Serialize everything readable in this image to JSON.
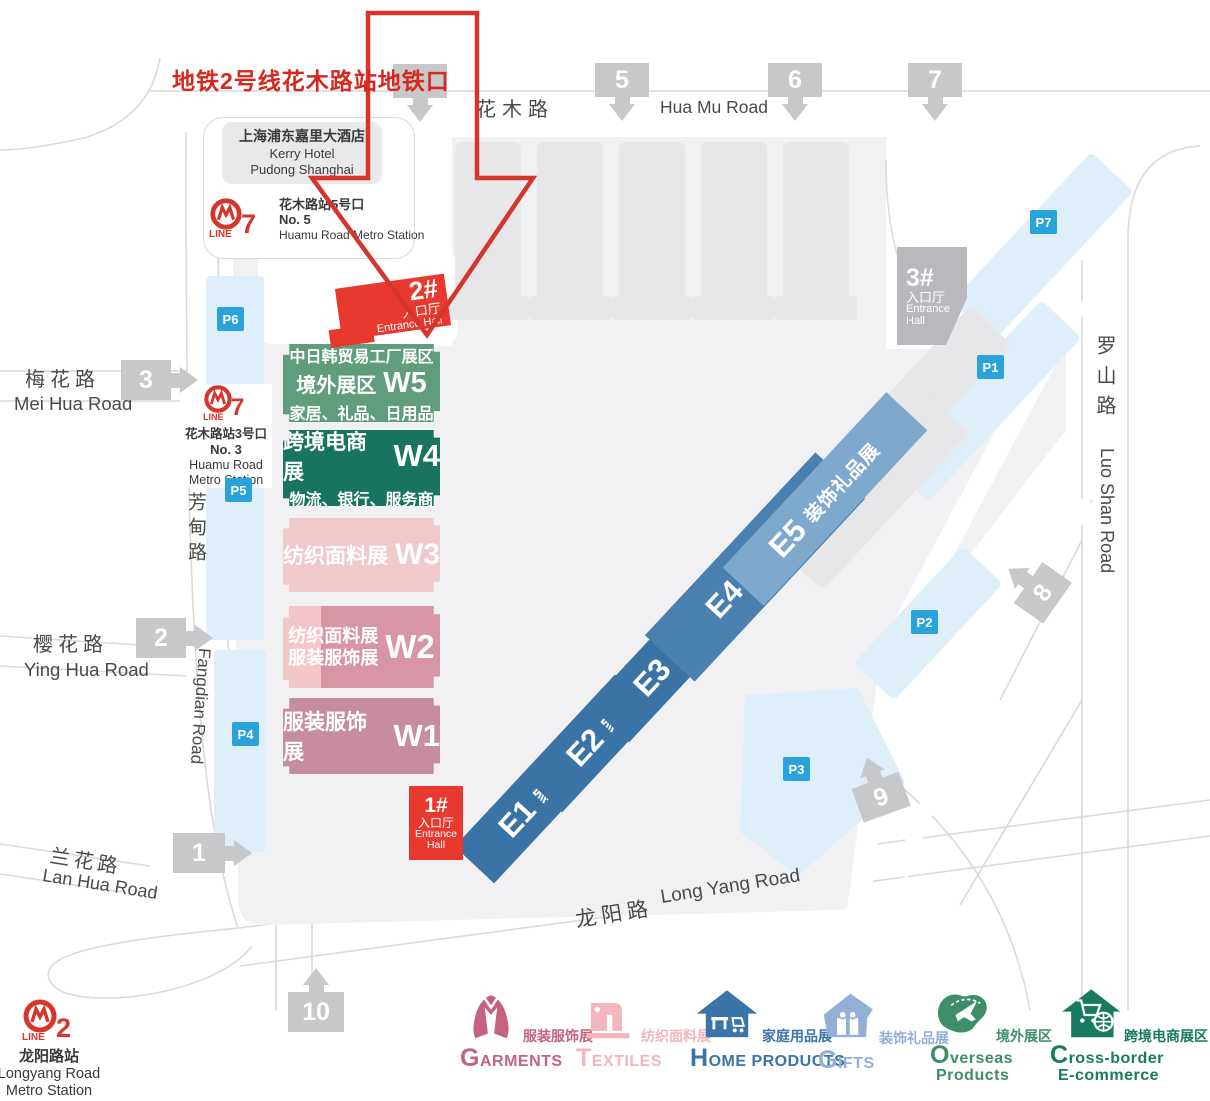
{
  "callout_title": "地铁2号线花木路站地铁口",
  "hotel": {
    "zh": "上海浦东嘉里大酒店",
    "en1": "Kerry Hotel",
    "en2": "Pudong Shanghai"
  },
  "metro": {
    "line_word": "LINE",
    "line7_no5": {
      "num": "7",
      "exit_zh": "花木路站5号口",
      "exit_en": "No. 5",
      "st_en": "Huamu Road Metro Station"
    },
    "line7_no3": {
      "num": "7",
      "exit_zh": "花木路站3号口",
      "exit_en": "No. 3",
      "st_en1": "Huamu Road",
      "st_en2": "Metro Station"
    },
    "line2": {
      "num": "2",
      "st_zh": "龙阳路站",
      "st_en1": "Longyang Road",
      "st_en2": "Metro Station"
    }
  },
  "roads": {
    "huamu_zh": "花木路",
    "huamu_en": "Hua Mu Road",
    "meihua_zh": "梅花路",
    "meihua_en": "Mei Hua Road",
    "yinghua_zh": "樱花路",
    "yinghua_en": "Ying Hua Road",
    "lanhua_zh": "兰花路",
    "lanhua_en": "Lan Hua Road",
    "fangdian_zh": "芳甸路",
    "fangdian_en": "Fangdian Road",
    "longyang_zh": "龙阳路",
    "longyang_en": "Long Yang Road",
    "luoshan_zh": "罗山路",
    "luoshan_en": "Luo Shan Road"
  },
  "gates": {
    "g1": "1",
    "g2": "2",
    "g3": "3",
    "g5": "5",
    "g6": "6",
    "g7": "7",
    "g8": "8",
    "g9": "9",
    "g10": "10"
  },
  "parking": {
    "p1": "P1",
    "p2": "P2",
    "p3": "P3",
    "p4": "P4",
    "p5": "P5",
    "p6": "P6",
    "p7": "P7"
  },
  "entrances": {
    "e1": {
      "num": "1#",
      "zh": "入口厅",
      "en1": "Entrance",
      "en2": "Hall"
    },
    "e2": {
      "num": "2#",
      "zh": "入口厅",
      "en": "Entrance Hall"
    },
    "e3": {
      "num": "3#",
      "zh": "入口厅",
      "en1": "Entrance",
      "en2": "Hall"
    }
  },
  "halls": {
    "w5": {
      "l1": "中日韩贸易工厂展区",
      "l2": "境外展区",
      "id": "W5",
      "l3": "家居、礼品、日用品"
    },
    "w4": {
      "l1": "跨境电商展",
      "id": "W4",
      "l2": "物流、银行、服务商"
    },
    "w3": {
      "l1": "纺织面料展",
      "id": "W3"
    },
    "w2": {
      "l1": "纺织面料展",
      "l2": "服装服饰展",
      "id": "W2"
    },
    "w1": {
      "l1": "服装服饰展",
      "id": "W1"
    },
    "e1": {
      "id": "E1",
      "label": "家庭用品展"
    },
    "e2": {
      "id": "E2",
      "label": "家庭用品展"
    },
    "e3": {
      "id": "E3",
      "label": "家庭用品展"
    },
    "e4": {
      "id": "E4",
      "l1": "装饰礼品展",
      "l2": "家庭用品展"
    },
    "e5": {
      "id": "E5",
      "label": "装饰礼品展"
    }
  },
  "legend": [
    {
      "first": "G",
      "rest": "ARMENTS",
      "zh": "服装服饰展"
    },
    {
      "first": "T",
      "rest": "EXTILES",
      "zh": "纺织面料展"
    },
    {
      "first": "H",
      "rest": "OME PRODUCTS",
      "zh": "家庭用品展"
    },
    {
      "first": "G",
      "rest": "IFTS",
      "zh": "装饰礼品展"
    },
    {
      "first": "O",
      "rest": "verseas",
      "line2": "Products",
      "zh": "境外展区"
    },
    {
      "first": "C",
      "rest": "ross-border",
      "line2": "E-commerce",
      "zh": "跨境电商展区"
    }
  ],
  "colors": {
    "red_accent": "#e8392f",
    "callout_red": "#d7271e",
    "w5_green": "#5f9d7d",
    "w4_teal": "#19745f",
    "w3_pink": "#f0c9cb",
    "w2_pink": "#d795a5",
    "w1_mauve": "#c68da2",
    "e_blue": "#3a74a6",
    "e4_blue": "#4a80b0",
    "e5_blue": "#7fa8cd",
    "parking_blue": "#2aa2da",
    "parking_strip": "#dfeffa",
    "gate_gray": "#c8c8cb",
    "expo_gray": "#f1f1f3",
    "building_gray": "#e7e7e9",
    "entrance3_gray": "#b9b9bd",
    "legend_garments": "#c4637f",
    "legend_textiles": "#f2b6bb",
    "legend_home": "#3a74a8",
    "legend_gifts": "#93afd7",
    "legend_overseas": "#3e8e68",
    "legend_crossborder": "#187a61"
  }
}
